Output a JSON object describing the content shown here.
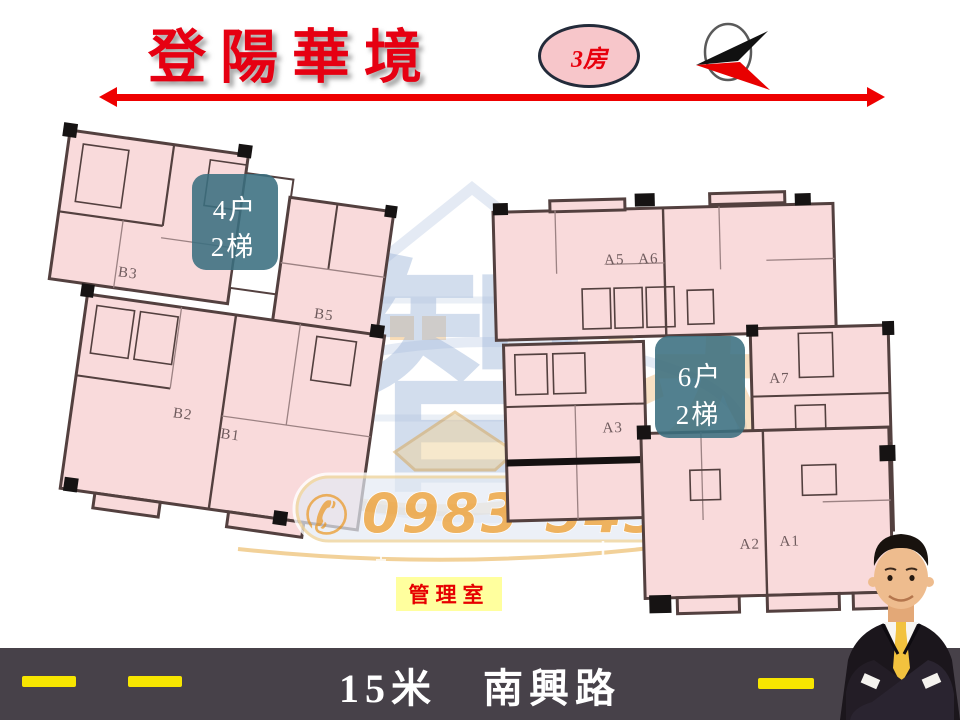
{
  "header": {
    "title": "登陽華境",
    "badge_label": "3房"
  },
  "buildings": {
    "left": {
      "stair_note": {
        "line1": "4户",
        "line2": "2梯"
      },
      "units": [
        "B3",
        "B5",
        "B2",
        "B1"
      ]
    },
    "right": {
      "stair_note": {
        "line1": "6户",
        "line2": "2梯"
      },
      "units": [
        "A5",
        "A6",
        "A7",
        "A3",
        "A2",
        "A1"
      ]
    }
  },
  "watermark": {
    "char1": "智",
    "char2": "块",
    "phone_icon": "✆",
    "phone": "0983-54316"
  },
  "management_label": "管理室",
  "road": {
    "label": "15米　南興路"
  },
  "colors": {
    "title_red": "#e60012",
    "arrow_red": "#ee0000",
    "plan_pink": "#f9dadb",
    "wall_dark": "#53403f",
    "stair_teal": "#3a6e80",
    "phone_gold": "#edaa4e",
    "note_yellow": "#ffff9e",
    "road_gray": "#474149",
    "dash_yellow": "#f7e600"
  }
}
